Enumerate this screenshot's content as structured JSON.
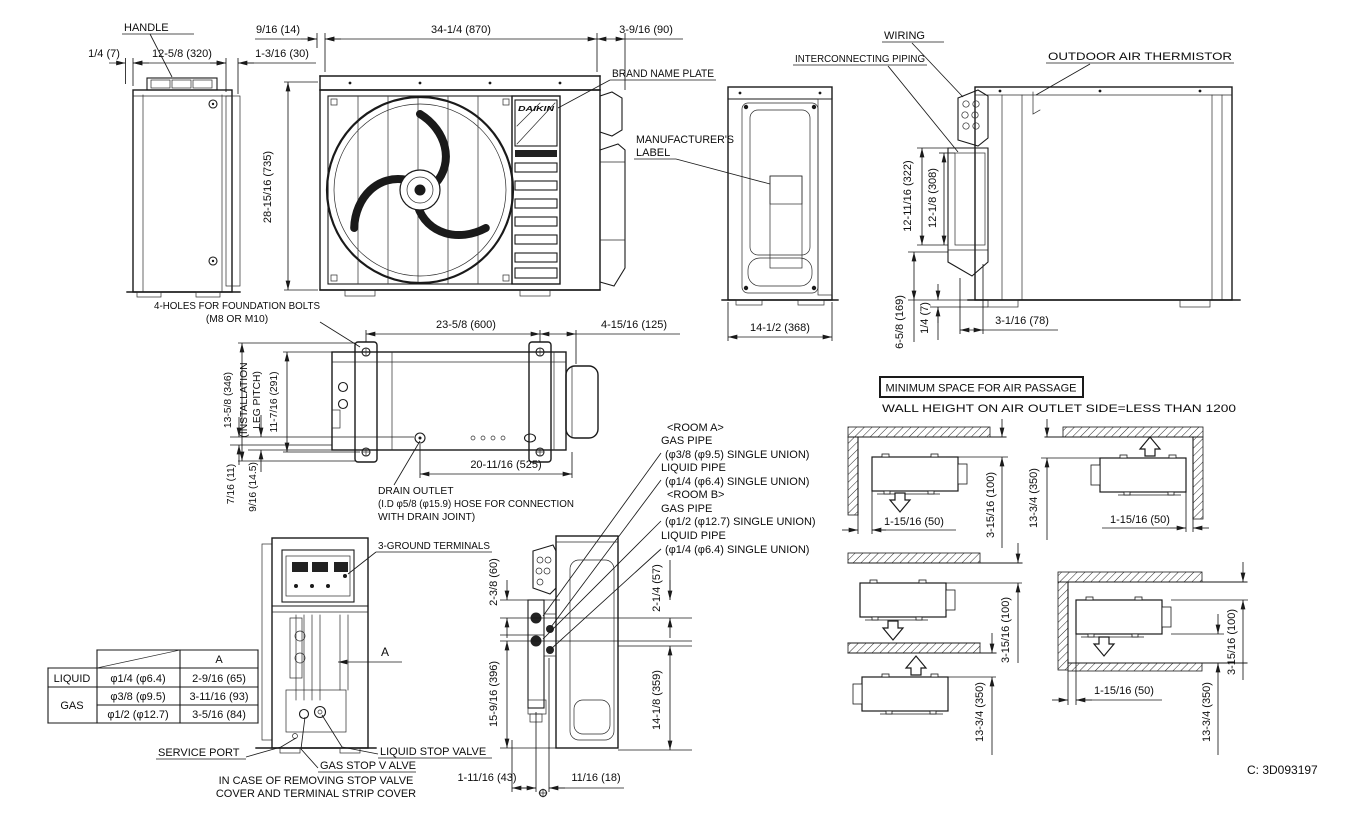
{
  "drawing_code": "C: 3D093197",
  "brand_plate": {
    "brand": "DAIKIN"
  },
  "labels": {
    "handle": "HANDLE",
    "brand_name_plate": "BRAND NAME PLATE",
    "manufacturers_label": [
      "MANUFACTURER'S",
      "LABEL"
    ],
    "wiring": "WIRING",
    "interconnecting_piping": "INTERCONNECTING PIPING",
    "outdoor_air_thermistor": "OUTDOOR AIR THERMISTOR",
    "foundation_bolts": [
      "4-HOLES FOR FOUNDATION BOLTS",
      "(M8 OR M10)"
    ],
    "drain_outlet": [
      "DRAIN OUTLET",
      "(I.D φ5/8 (φ15.9) HOSE FOR CONNECTION",
      "WITH DRAIN JOINT)"
    ],
    "ground_terminals": "3-GROUND TERMINALS",
    "service_port": "SERVICE PORT",
    "liquid_stop_valve": "LIQUID STOP VALVE",
    "gas_stop_valve": "GAS STOP V ALVE",
    "stop_valve_note": [
      "IN CASE OF REMOVING STOP VALVE",
      "COVER AND TERMINAL STRIP COVER"
    ],
    "section_a": "A"
  },
  "piping_callouts": [
    "<ROOM A>",
    "GAS PIPE",
    "(φ3/8 (φ9.5) SINGLE UNION)",
    "LIQUID PIPE",
    "(φ1/4 (φ6.4) SINGLE UNION)",
    "<ROOM B>",
    "GAS PIPE",
    "(φ1/2 (φ12.7) SINGLE UNION)",
    "LIQUID PIPE",
    "(φ1/4 (φ6.4) SINGLE UNION)"
  ],
  "dimensions": {
    "handle_offset": "1/4 (7)",
    "side_depth": "12-5/8 (320)",
    "side_fin": "1-3/16 (30)",
    "cap_gap": "9/16 (14)",
    "front_width": "34-1/4 (870)",
    "front_side": "3-9/16 (90)",
    "front_height": "28-15/16 (735)",
    "leg_pitch_w": "23-5/8 (600)",
    "plan_right": "4-15/16 (125)",
    "plan_depth": "13-5/8 (346)",
    "leg_pitch_note": [
      "(INSTALLATION",
      "LEG PITCH)"
    ],
    "leg_pitch_d": "11-7/16 (291)",
    "drain_off_1": "7/16 (11)",
    "drain_off_2": "9/16 (14.5)",
    "drain_pos": "20-11/16 (525)",
    "side_width": "14-1/2 (368)",
    "piping_h1": "12-11/16 (322)",
    "piping_h2": "12-1/8 (308)",
    "base_h": "6-5/8 (169)",
    "base_off": "1/4 (7)",
    "base_w": "3-1/16 (78)",
    "valve_top": "2-3/8 (60)",
    "valve_bottom": "15-9/16 (396)",
    "valve_top_r": "2-1/4 (57)",
    "valve_bottom_r": "14-1/8 (359)",
    "valve_b1": "1-11/16 (43)",
    "valve_b2": "11/16 (18)"
  },
  "min_space": {
    "title": "MINIMUM SPACE FOR AIR PASSAGE",
    "subtitle": "WALL HEIGHT ON AIR OUTLET SIDE=LESS THAN 1200",
    "side_clearance": "1-15/16 (50)",
    "suction_clearance": "3-15/16 (100)",
    "outlet_clearance": "13-3/4 (350)"
  },
  "pipe_table": {
    "header_a": "A",
    "rows": [
      {
        "label": "LIQUID",
        "size": "φ1/4 (φ6.4)",
        "dim_a": "2-9/16 (65)"
      },
      {
        "label": "GAS",
        "size": "φ3/8 (φ9.5)",
        "dim_a": "3-11/16 (93)"
      },
      {
        "label": "",
        "size": "φ1/2 (φ12.7)",
        "dim_a": "3-5/16 (84)"
      }
    ]
  }
}
